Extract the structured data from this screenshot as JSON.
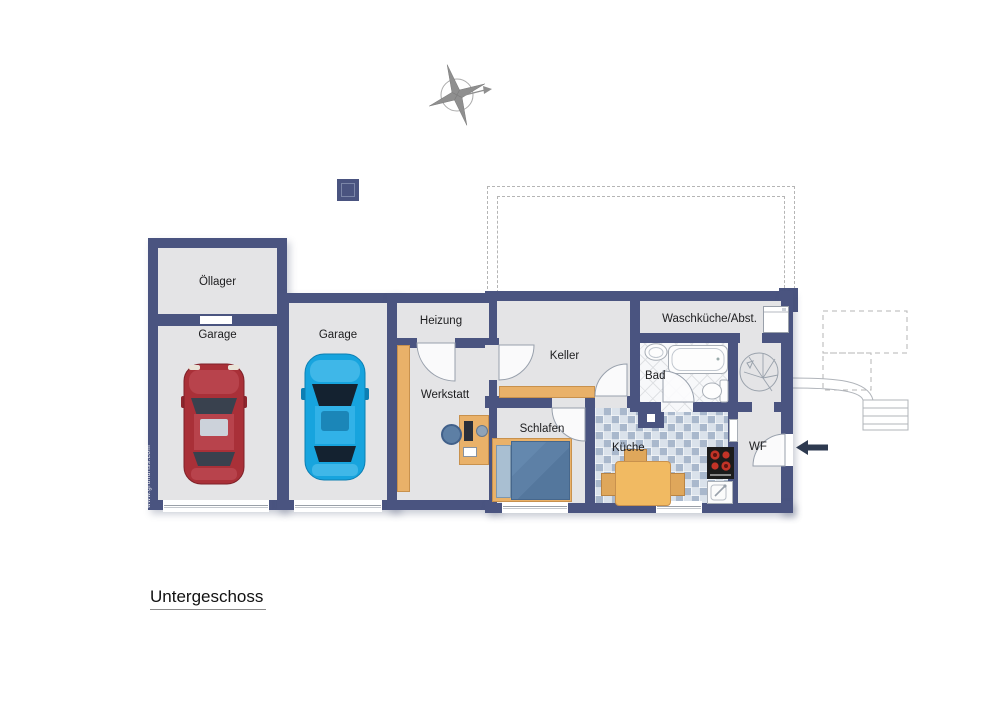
{
  "plan": {
    "title": "Untergeschoss",
    "watermark": "www.grundriss.com",
    "rooms": {
      "oellager": {
        "label": "Öllager"
      },
      "garage_left": {
        "label": "Garage"
      },
      "garage_right": {
        "label": "Garage"
      },
      "heizung": {
        "label": "Heizung"
      },
      "werkstatt": {
        "label": "Werkstatt"
      },
      "keller": {
        "label": "Keller"
      },
      "waschkueche": {
        "label": "Waschküche/Abst."
      },
      "bad": {
        "label": "Bad"
      },
      "schlafen": {
        "label": "Schlafen"
      },
      "kueche": {
        "label": "Küche"
      },
      "wf": {
        "label": "WF"
      }
    },
    "colors": {
      "wall": "#4a5480",
      "floor": "#e4e4e6",
      "wood": "#e9b169",
      "tile_blue": "#c3cfdc",
      "car_red": "#a93038",
      "car_blue": "#17a4de",
      "burner_red": "#c23327"
    },
    "symbols": [
      "compass-rose",
      "chimney",
      "terrace-dashed-outline",
      "red-car",
      "blue-car",
      "workbench",
      "desk-with-chair",
      "storage-shelf",
      "double-bed",
      "dining-table",
      "stove",
      "kitchen-sink",
      "washing-machine",
      "bathroom-sink",
      "bathtub",
      "toilet",
      "spiral-staircase",
      "entrance-arrow",
      "exterior-stairs",
      "garage-door",
      "window",
      "door-arc"
    ]
  }
}
